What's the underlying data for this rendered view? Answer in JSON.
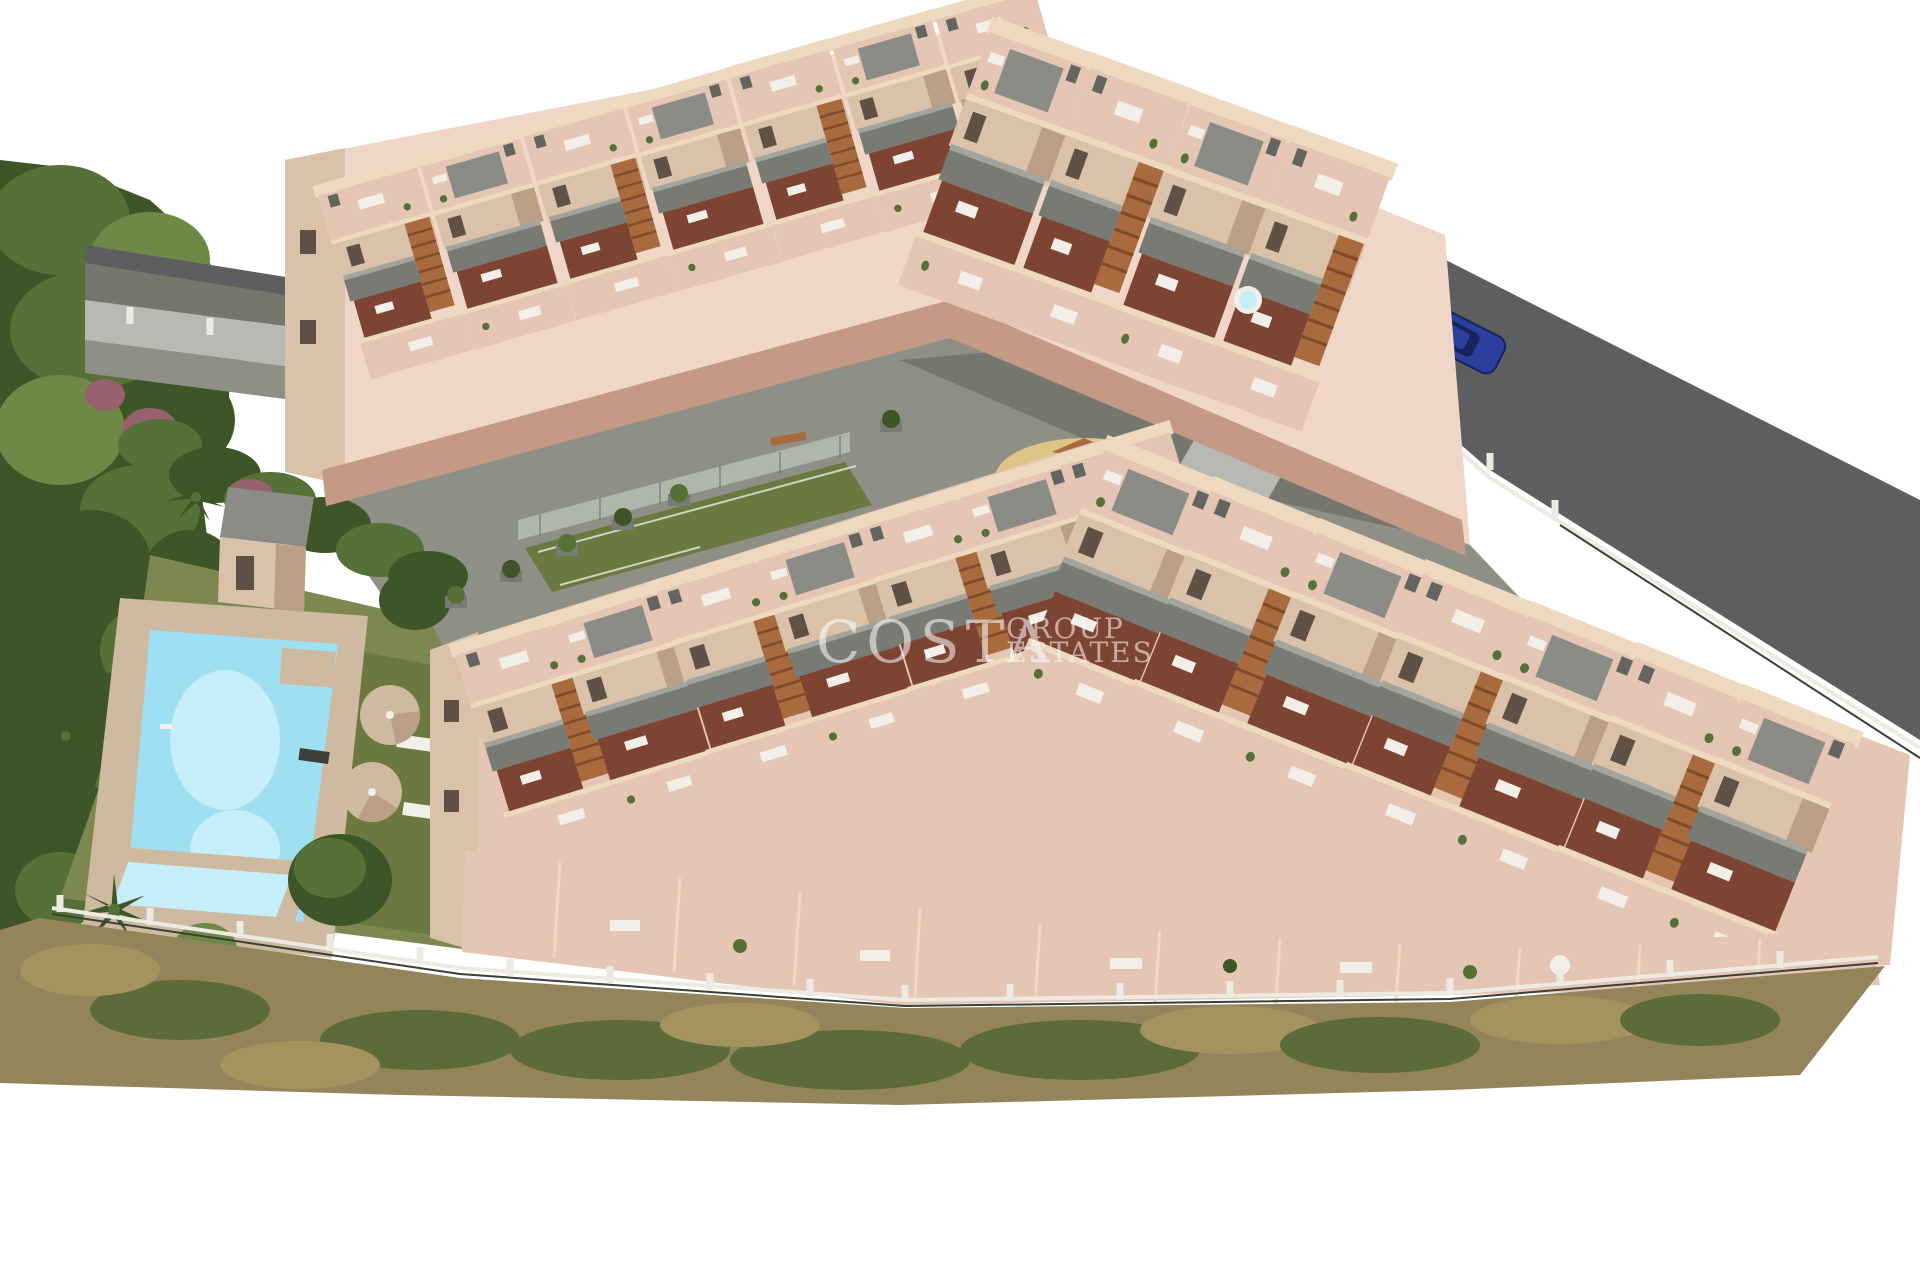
{
  "meta": {
    "alt": "Aerial 3D architectural rendering of a new-build terraced apartment complex with pink-tiled roof terraces, balconies and stairs, a communal garden with swimming pool and kids pool, sun umbrellas, a padel court, a central playground, perimeter fencing, dry scrubland slope at the bottom and a gray perimeter road with a parked blue car",
    "background": "#ffffff"
  },
  "watermark": {
    "word_main": "COSTA",
    "word_top": "GROUP",
    "word_bottom": "ESTATES",
    "opacity": "0.55"
  },
  "palette": {
    "sky": "#ffffff",
    "treeDark": "#3e5528",
    "treeMid": "#567138",
    "treeLite": "#6d8847",
    "treePurple": "#96606e",
    "lawn": "#7c8850",
    "lawnDark": "#6b783f",
    "scrubBase": "#93845c",
    "scrubGreen": "#5d6a39",
    "scrubBrown": "#a5935f",
    "paving": "#8e9086",
    "pavingDark": "#75776d",
    "road": "#5d5e60",
    "curb": "#b9b9b4",
    "wall": "#d9c2a9",
    "wallLight": "#ecd9bf",
    "wallDark": "#bb9f86",
    "terrace": "#e5c6b5",
    "terraceLight": "#efd6c7",
    "terraceDark": "#c49a87",
    "underFloor": "#7e4433",
    "balcony": "#787b74",
    "balconyLight": "#a3a59d",
    "panel": "#8b8c86",
    "stairWood": "#a96a3e",
    "stairDark": "#7e4c2a",
    "pool": "#9edff2",
    "poolLight": "#c6eef9",
    "deck": "#cdbaa0",
    "sand": "#dfc488",
    "fenceLight": "#eceae2",
    "fenceDark": "#3c3f38",
    "carBody": "#2c3f9e",
    "carGlass": "#19245c",
    "furnWhite": "#f2efe8",
    "watermark": "#ffffff"
  }
}
